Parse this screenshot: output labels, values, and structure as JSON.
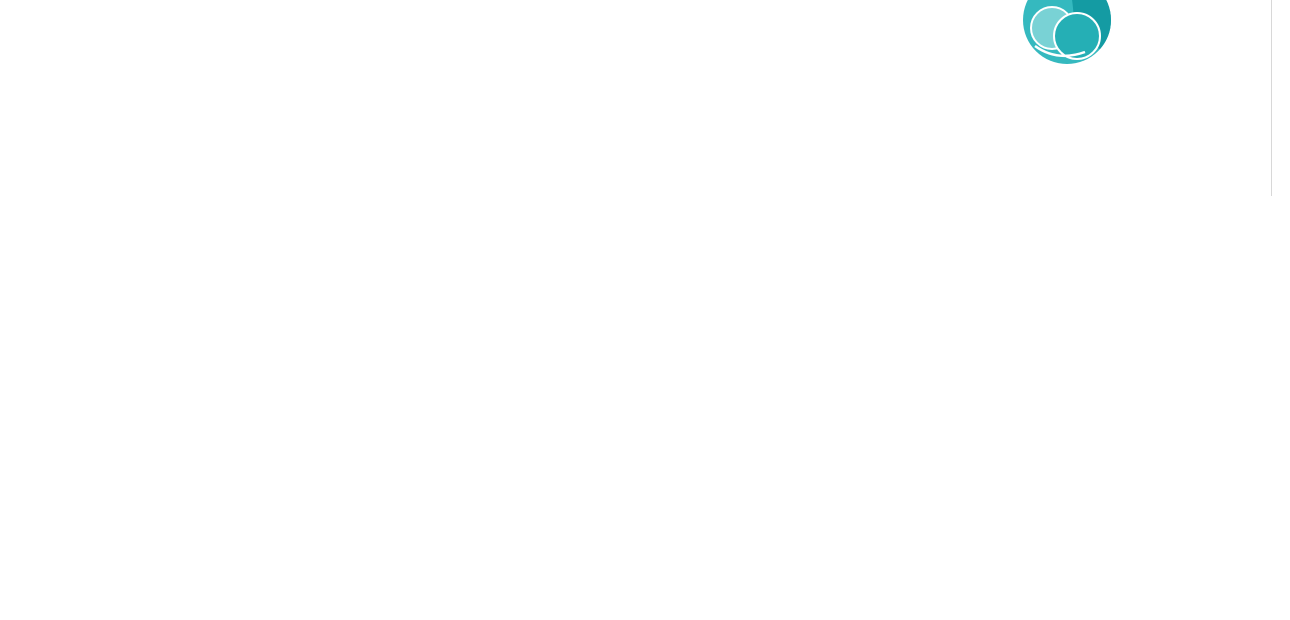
{
  "title": "bloque 4 ordenación general",
  "branding": {
    "name": "Flamenca Sun",
    "tagline": "LIVING BY THE SEA",
    "url_primary": "www.vistabellagolfhomes.com",
    "url_secondary": "www.residencialplayaflamenca.com",
    "logo_teal_dark": "#149ba3",
    "logo_teal_mid": "#35b9bf",
    "logo_teal_light": "#79d2d5"
  },
  "site_map": {
    "highlight_color": "#92ccd9",
    "pool_color": "#b9e7ef",
    "labels": {
      "bloque5": "nº.5",
      "bloque4_l1": "BLOQUE",
      "bloque4_l2": "nº.4",
      "bloque1": "BLOQUE nº.1",
      "bloque2": "BLOQUE nº.2",
      "bloque3_l1": "BLOQUE",
      "bloque3_l2": "nº.3"
    }
  },
  "floor_plan": {
    "stair1_label": "ESCALERA nº1",
    "stair2_label": "ESCALERA nº2",
    "top_left_storage": [
      "T01",
      "T03",
      "T05",
      "T07",
      "T09",
      "T11"
    ],
    "top_left_spaces": [
      "01",
      "03",
      "05",
      "07",
      "09",
      "11"
    ],
    "top_right_storage": [
      "T13",
      "T15",
      "T17",
      "T19",
      "T21",
      "T23",
      "T25",
      "T27"
    ],
    "top_right_spaces": [
      "13",
      "15",
      "17",
      "19",
      "21",
      "23",
      "25",
      "27"
    ],
    "bottom_left_spaces": [
      "02",
      "04",
      "06",
      "08",
      "10",
      "12",
      "14",
      "16"
    ],
    "bottom_right_spaces": [
      "18",
      "20",
      "22",
      "24",
      "26",
      "28",
      "29",
      "30",
      "R1",
      "R2"
    ],
    "bottom_left_storage": [
      "T02",
      "T04",
      "T06",
      "T08"
    ],
    "utility_labels": [
      "cuarto s. electricos",
      "cuarto agua",
      "pasillo"
    ],
    "accessible_spaces": [
      "01",
      "02",
      "27"
    ]
  },
  "icons": {
    "wheelchair": "♿"
  }
}
